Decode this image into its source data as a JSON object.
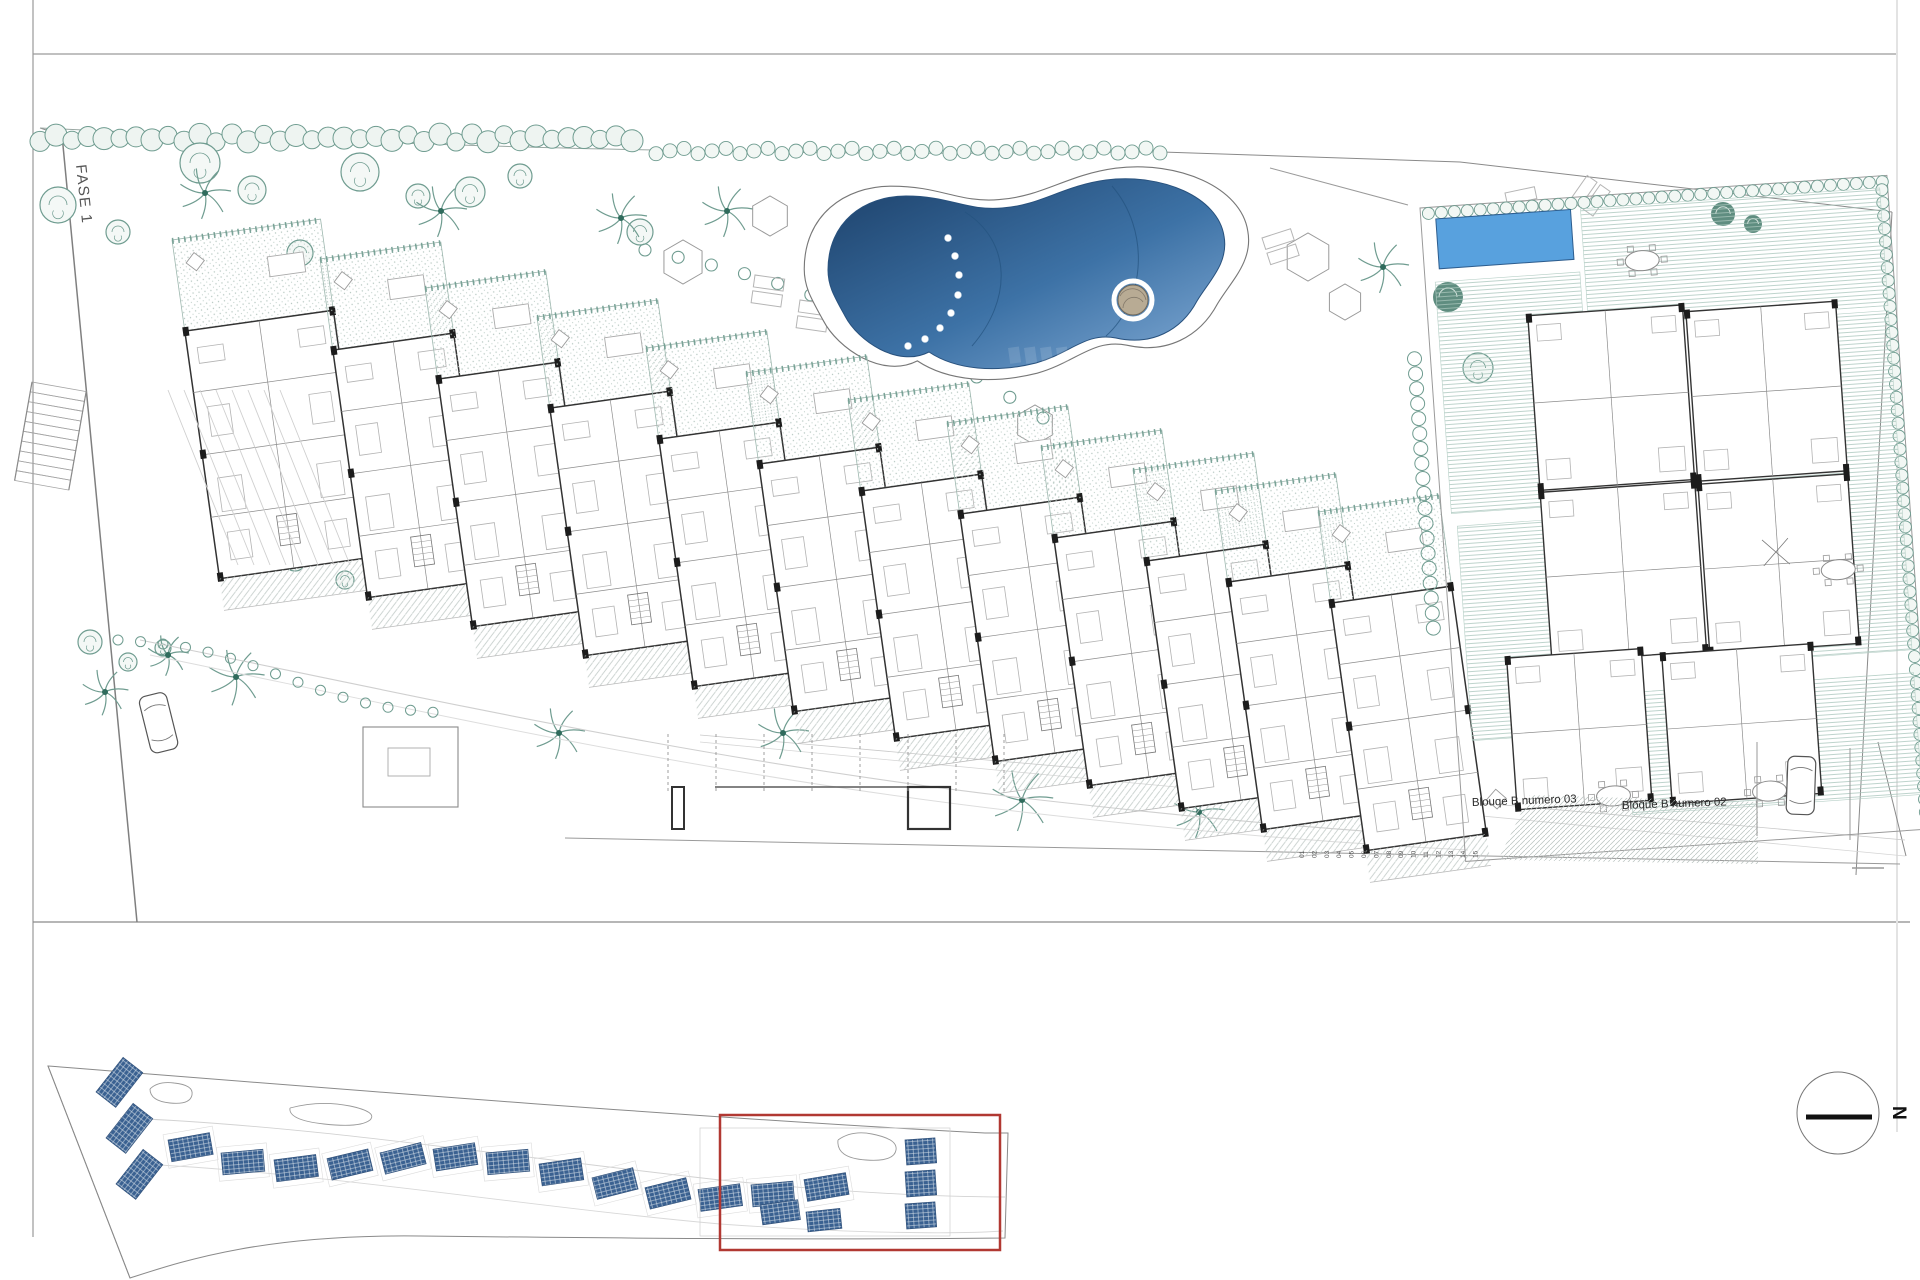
{
  "plan": {
    "phase_label": "FASE 1",
    "block03_label": "Blouqe B numero 03",
    "block02_label": "Bloque B numero 02",
    "north_label": "N",
    "parking_marks": [
      "01",
      "02",
      "03",
      "04",
      "05",
      "06",
      "07",
      "08",
      "09",
      "10",
      "11",
      "12",
      "13",
      "14",
      "15"
    ]
  },
  "colors": {
    "pool_deep": "#1c4069",
    "pool_mid": "#3d72a6",
    "pool_light": "#83acd6",
    "private_pool": "#58a1de",
    "private_pool_edge": "#2d5d8e",
    "vegetation": "#6f9c90",
    "vegetation_dark": "#4e8172",
    "key_block_blue": "#3a6191",
    "highlight_red": "#b13832",
    "frame_gray": "#8a8a8a",
    "building_dark": "#333333"
  }
}
